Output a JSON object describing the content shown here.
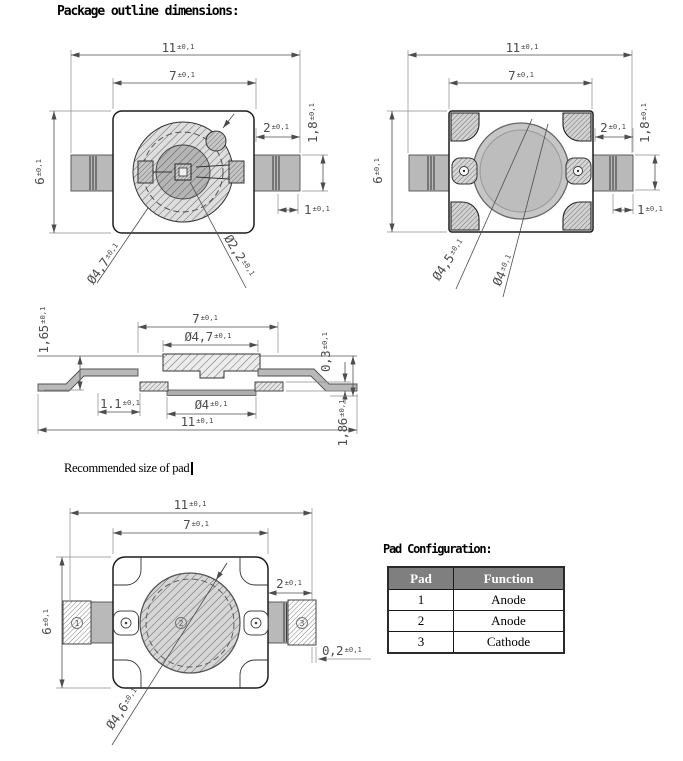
{
  "page": {
    "title": "Package outline dimensions:",
    "recommended_pad_label": "Recommended size of pad"
  },
  "colors": {
    "table_header_bg": "#7f7f7f",
    "table_header_text": "#ffffff",
    "lead_fill": "#b9b9b9",
    "line": "#1c1c1c"
  },
  "drawings": {
    "front": {
      "d11": {
        "v": "11",
        "t": "±0,1"
      },
      "d7": {
        "v": "7",
        "t": "±0,1"
      },
      "d2": {
        "v": "2",
        "t": "±0,1"
      },
      "d1_8": {
        "v": "1,8",
        "t": "±0,1"
      },
      "d6": {
        "v": "6",
        "t": "±0,1"
      },
      "d1": {
        "v": "1",
        "t": "±0,1"
      },
      "dia_lens": {
        "v": "Ø4,7",
        "t": "±0,1"
      },
      "dia_inner": {
        "v": "Ø2,2",
        "t": "±0,1"
      }
    },
    "back": {
      "d11": {
        "v": "11",
        "t": "±0,1"
      },
      "d7": {
        "v": "7",
        "t": "±0,1"
      },
      "d2": {
        "v": "2",
        "t": "±0,1"
      },
      "d1_8": {
        "v": "1,8",
        "t": "±0,1"
      },
      "d6": {
        "v": "6",
        "t": "±0,1"
      },
      "d1": {
        "v": "1",
        "t": "±0,1"
      },
      "dia_ring": {
        "v": "Ø4,5",
        "t": "±0,1"
      },
      "dia_hole": {
        "v": "Ø4",
        "t": "±0,1"
      }
    },
    "side": {
      "d1_65": {
        "v": "1,65",
        "t": "±0,1"
      },
      "d7": {
        "v": "7",
        "t": "±0,1"
      },
      "dia_top": {
        "v": "Ø4,7",
        "t": "±0,1"
      },
      "d0_3": {
        "v": "0,3",
        "t": "±0,1"
      },
      "d1_1": {
        "v": "1.1",
        "t": "±0,1"
      },
      "dia_bottom": {
        "v": "Ø4",
        "t": "±0,1"
      },
      "d11": {
        "v": "11",
        "t": "±0,1"
      },
      "d1_86": {
        "v": "1,86",
        "t": "±0,1"
      }
    },
    "pad": {
      "d11": {
        "v": "11",
        "t": "±0,1"
      },
      "d7": {
        "v": "7",
        "t": "±0,1"
      },
      "d2": {
        "v": "2",
        "t": "±0,1"
      },
      "d6": {
        "v": "6",
        "t": "±0,1"
      },
      "d0_2": {
        "v": "0,2",
        "t": "±0,1"
      },
      "dia_pad": {
        "v": "Ø4,6",
        "t": "±0,1"
      },
      "pin1": "1",
      "pin2": "2",
      "pin3": "3"
    }
  },
  "pad_config": {
    "title": "Pad Configuration:",
    "table": {
      "headers": [
        "Pad",
        "Function"
      ],
      "rows": [
        [
          "1",
          "Anode"
        ],
        [
          "2",
          "Anode"
        ],
        [
          "3",
          "Cathode"
        ]
      ]
    }
  }
}
